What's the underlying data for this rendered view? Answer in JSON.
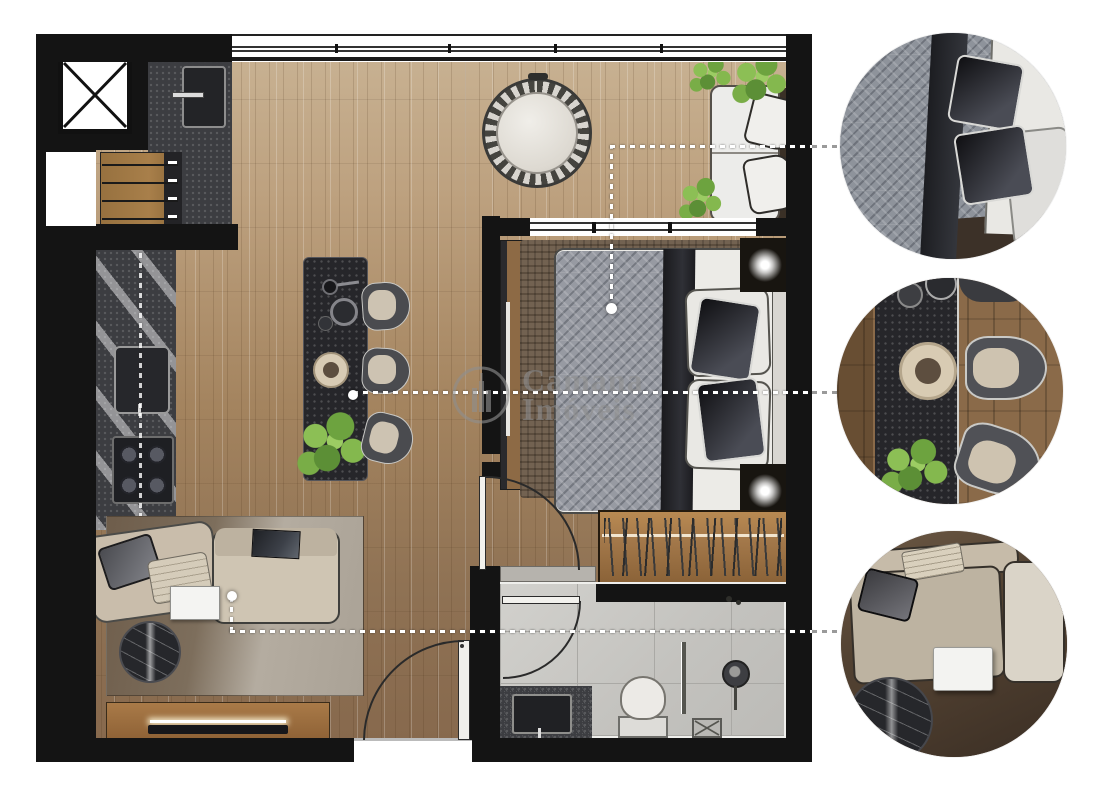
{
  "watermark": {
    "line1": "Camana",
    "line2": "Imóveis"
  },
  "palette": {
    "wall": "#141414",
    "floor_light": "#c9b394",
    "floor_dark": "#87694d",
    "counter_granite": "#3c3d41",
    "bathroom_tile": "#c6c5c1",
    "bedroom_rug": "#6b5a48",
    "duvet_gray": "#979aa2",
    "pillow_black": "#1d1d20",
    "sofa_beige": "#cfc5b3",
    "wardrobe_wood": "#a3784a",
    "plant_green": "#76a944",
    "marble_black": "#26272b",
    "leader_line_gray": "#9a9a9a",
    "watermark_gray": "#8f8f8f"
  },
  "icons": {
    "elevator": "x-cross-icon",
    "floor_drain": "x-cross-icon",
    "logo": "building-in-circle-icon"
  },
  "callouts": [
    {
      "subject": "bed-detail"
    },
    {
      "subject": "dining-table-detail"
    },
    {
      "subject": "sofa-detail"
    }
  ]
}
